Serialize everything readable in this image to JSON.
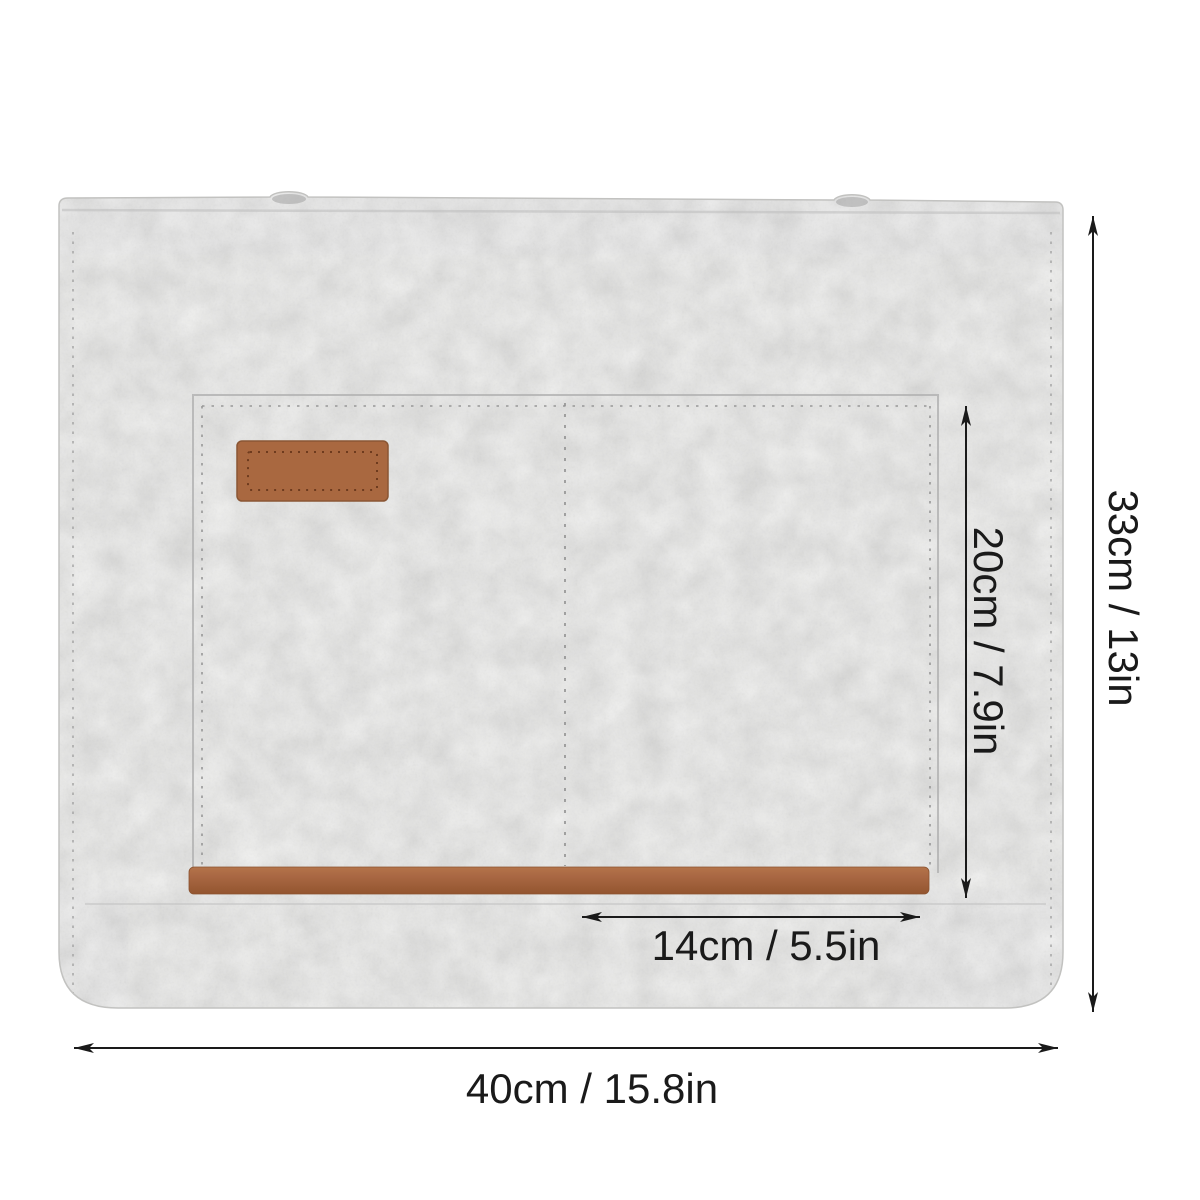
{
  "photo": {
    "object": "felt-laptop-sleeve",
    "features": [
      "front-pocket",
      "leather-patch",
      "leather-trim-strip",
      "snap-bumps",
      "stitch-seams"
    ]
  },
  "annotations": {
    "width_label": "40cm / 15.8in",
    "height_label": "33cm / 13in",
    "pocket_height_label": "20cm / 7.9in",
    "pocket_width_label": "14cm / 5.5in"
  },
  "colors": {
    "background": "#ffffff",
    "felt": "#d8d8d6",
    "leather": "#a96840",
    "leather_stitch": "#6e3b1e",
    "annotation_ink": "#1a1a1a"
  }
}
